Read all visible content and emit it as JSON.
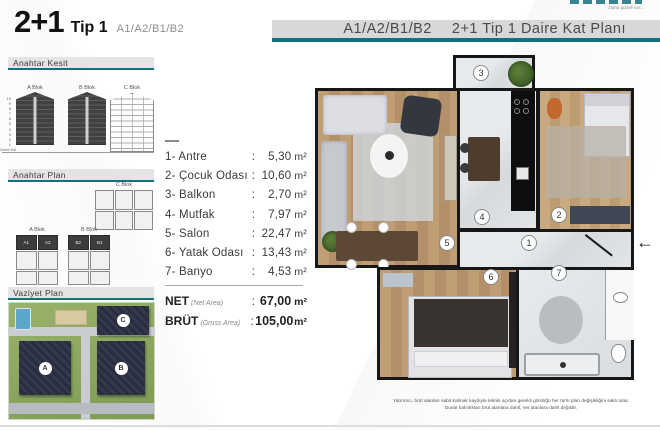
{
  "title": {
    "main": "2+1",
    "sub": "Tip 1",
    "units": "A1/A2/B1/B2"
  },
  "header": {
    "units": "A1/A2/B1/B2",
    "plan_title": "2+1 Tip 1 Daire Kat Planı",
    "logo_tagline": "Daha güzeli var..."
  },
  "sections": {
    "kesit": {
      "label": "Anahtar Kesit",
      "blocks": [
        {
          "name": "A Blok"
        },
        {
          "name": "B Blok"
        },
        {
          "name": "C Blok"
        }
      ],
      "floors": "10\n9\n8\n7\n6\n5\n4\n3\n2\n1",
      "ground": "Zemin Kat"
    },
    "plan": {
      "label": "Anahtar Plan",
      "c_label": "C Blok",
      "a_label": "A Blok",
      "b_label": "B Blok",
      "a_units": [
        "A1",
        "A2"
      ],
      "b_units": [
        "B2",
        "B1"
      ]
    },
    "vaziyet": {
      "label": "Vaziyet Plan",
      "buildings": [
        "A",
        "B",
        "C"
      ]
    }
  },
  "rooms": [
    {
      "no": "1-",
      "name": "Antre",
      "value": "5,30",
      "unit": "m²"
    },
    {
      "no": "2-",
      "name": "Çocuk Odası",
      "value": "10,60",
      "unit": "m²"
    },
    {
      "no": "3-",
      "name": "Balkon",
      "value": "2,70",
      "unit": "m²"
    },
    {
      "no": "4-",
      "name": "Mutfak",
      "value": "7,97",
      "unit": "m²"
    },
    {
      "no": "5-",
      "name": "Salon",
      "value": "22,47",
      "unit": "m²"
    },
    {
      "no": "6-",
      "name": "Yatak Odası",
      "value": "13,43",
      "unit": "m²"
    },
    {
      "no": "7-",
      "name": "Banyo",
      "value": "4,53",
      "unit": "m²"
    }
  ],
  "totals": {
    "net": {
      "label": "NET",
      "sub": "(Net Area)",
      "value": "67,00",
      "unit": "m²"
    },
    "brut": {
      "label": "BRÜT",
      "sub": "(Gross Area)",
      "value": "105,00",
      "unit": "m²"
    }
  },
  "badges": [
    "1",
    "2",
    "3",
    "4",
    "5",
    "6",
    "7"
  ],
  "entry_arrow": "←",
  "disclaimer": {
    "line1": "Yatırımcı, brüt alanları sabit kalmak kaydıyla teknik açıdan gerekli gördüğü her türlü plan değişikliğini saklı tutar.",
    "line2": "Duvar kalınlıkları brüt alanlara dahil, net alanlara dahil değildir."
  },
  "colors": {
    "accent_teal": "#15707e",
    "wall_black": "#171717",
    "site_green": "#8aa65e",
    "building_navy": "#272c3f"
  }
}
